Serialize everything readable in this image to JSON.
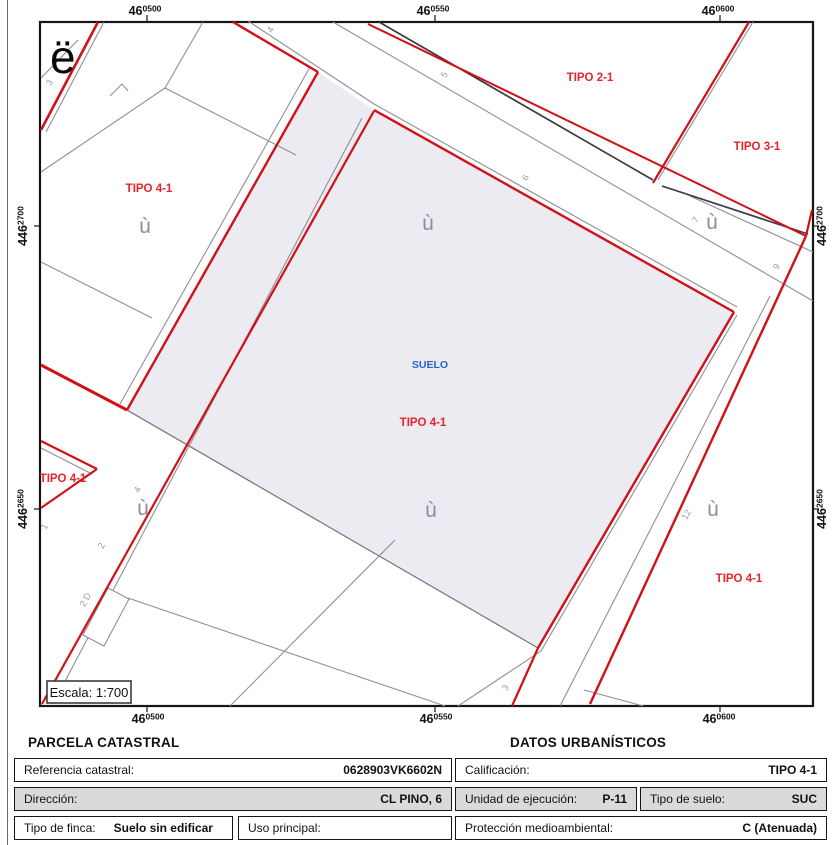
{
  "map": {
    "north_symbol": "ë",
    "grid_symbol": "ù",
    "scale_text": "Escala: 1:700",
    "suelo_label": "SUELO",
    "coord_top": [
      {
        "m": "46",
        "s": "0500"
      },
      {
        "m": "46",
        "s": "0550"
      },
      {
        "m": "46",
        "s": "0600"
      }
    ],
    "coord_bottom": [
      {
        "m": "46",
        "s": "0500"
      },
      {
        "m": "46",
        "s": "0550"
      },
      {
        "m": "46",
        "s": "0600"
      }
    ],
    "coord_left": [
      {
        "m": "446",
        "s": "2700"
      },
      {
        "m": "446",
        "s": "2650"
      }
    ],
    "coord_right": [
      {
        "m": "446",
        "s": "2700"
      },
      {
        "m": "446",
        "s": "2650"
      }
    ],
    "zones": {
      "upper_left": "TIPO 4-1",
      "top_right_a": "TIPO 2-1",
      "top_right_b": "TIPO 3-1",
      "main": "TIPO 4-1",
      "lower_left": "TIPO 4-1",
      "lower_right": "TIPO 4-1"
    },
    "street_numbers": {
      "n1": "3",
      "n2": "4",
      "n3": "5",
      "n4": "6",
      "n5": "7",
      "n6": "9",
      "n7": "4",
      "n8": "2",
      "n9": "1",
      "n10": "2 D",
      "n11": "12",
      "n12": "3"
    },
    "colors": {
      "red_line": "#d01118",
      "zone_red": "#e5252b",
      "suelo_blue": "#2a63cc",
      "parcel_shade": "#ebebf1",
      "gray_line": "#8f9097"
    }
  },
  "parcela": {
    "title": "PARCELA CATASTRAL",
    "ref_label": "Referencia catastral:",
    "ref_value": "0628903VK6602N",
    "dir_label": "Dirección:",
    "dir_value": "CL PINO, 6",
    "finca_label": "Tipo de finca:",
    "finca_value": "Suelo sin edificar",
    "uso_label": "Uso principal:",
    "uso_value": ""
  },
  "datos": {
    "title": "DATOS URBANÍSTICOS",
    "calif_label": "Calificación:",
    "calif_value": "TIPO 4-1",
    "unidad_label": "Unidad de ejecución:",
    "unidad_value": "P-11",
    "tipo_suelo_label": "Tipo de suelo:",
    "tipo_suelo_value": "SUC",
    "prot_label": "Protección medioambiental:",
    "prot_value": "C (Atenuada)"
  }
}
